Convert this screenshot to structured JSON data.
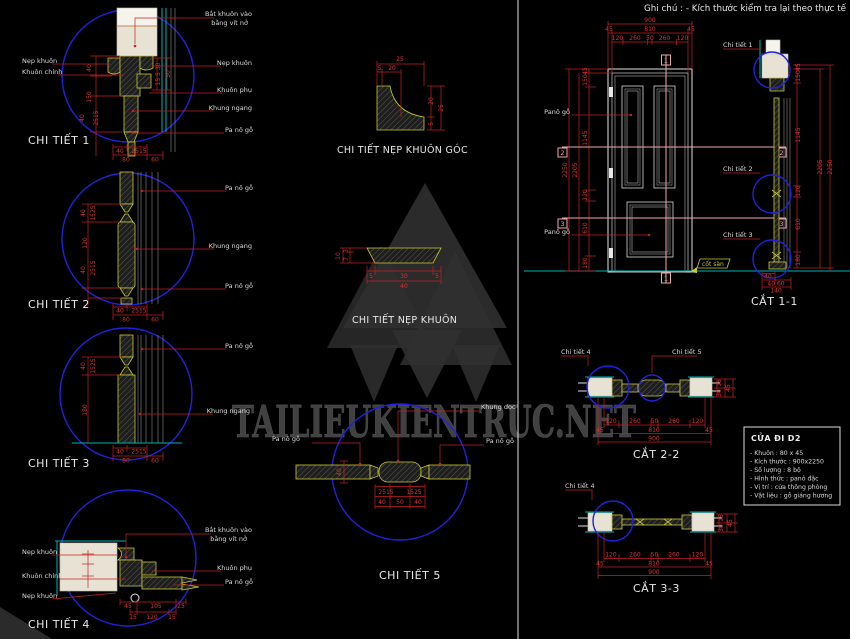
{
  "app": {
    "background": "#000000",
    "red": "#c32222",
    "yellow": "#c9c932",
    "cyan": "#00b4b4",
    "blue": "#2121dc",
    "pink": "#efa8a8"
  },
  "note": {
    "ghi_chu": "Ghi chú : - Kích thước kiểm tra lại theo thực tế"
  },
  "watermark": {
    "text": "TAILIEUKIENTRUC.NET"
  },
  "details": {
    "d1": {
      "title": "CHI TIẾT 1",
      "labels_left": [
        "Nẹp khuôn",
        "Khuôn chính"
      ],
      "labels_right": [
        "Bắt khuôn vào",
        "bằng vít nở",
        "Nẹp khuôn",
        "Khuôn phụ",
        "Khung ngang",
        "Pa nô gỗ"
      ],
      "dims_left": [
        "40",
        "150",
        "2515",
        "40"
      ],
      "dims_right": [
        "15 5 30",
        "50"
      ],
      "dims_bottom": [
        "40",
        "2515",
        "80",
        "60"
      ]
    },
    "d2": {
      "title": "CHI TIẾT 2",
      "labels_right": [
        "Pa nô gỗ",
        "Khung ngang",
        "Pa nô gỗ"
      ],
      "dims_left": [
        "40",
        "1525",
        "120",
        "2515",
        "40"
      ],
      "dims_bottom": [
        "40",
        "2515",
        "80",
        "60"
      ]
    },
    "d3": {
      "title": "CHI TIẾT 3",
      "labels_right": [
        "Pa nô gỗ",
        "Khung ngang"
      ],
      "dims_left": [
        "40",
        "1525",
        "180"
      ],
      "dims_bottom": [
        "40",
        "2515",
        "80",
        "60"
      ]
    },
    "d4": {
      "title": "CHI TIẾT 4",
      "labels_left": [
        "Nẹp khuôn",
        "Khuôn chính",
        "Nẹp khuôn"
      ],
      "labels_right": [
        "Bắt khuôn vào",
        "bằng vít nở",
        "Khuôn phụ",
        "Pa nô gỗ"
      ],
      "dims_row1": [
        "45",
        "105",
        "25"
      ],
      "dims_row2": [
        "15",
        "120",
        "15"
      ]
    },
    "d5": {
      "title": "CHI TIẾT 5",
      "labels": [
        "Khung dọc",
        "Pa nô gỗ",
        "Pa nô gỗ"
      ],
      "dim_left": "40",
      "dims_row1": [
        "2515",
        "1525"
      ],
      "dims_row2": [
        "40",
        "50",
        "40"
      ]
    },
    "goc": {
      "title": "CHI TIẾT NẸP KHUÔN GÓC",
      "dims_top": [
        "25",
        "5",
        "20"
      ],
      "dims_right": [
        "20",
        "5",
        "25"
      ]
    },
    "nep": {
      "title": "CHI TIẾT NẸP KHUÔN",
      "dims_left": [
        "3",
        "7",
        "10"
      ],
      "dims_bottom": [
        "5",
        "30",
        "5",
        "40"
      ]
    }
  },
  "elevation": {
    "labels": [
      "Panô gỗ",
      "Panô gỗ"
    ],
    "dims_top_total": "900",
    "dims_top_mid": [
      "45",
      "810",
      "45"
    ],
    "dims_top_inner": [
      "120",
      "260",
      "50",
      "260",
      "120"
    ],
    "dims_left": [
      "45",
      "150",
      "1145",
      "120",
      "610",
      "180"
    ],
    "dims_left_totals": [
      "2205",
      "2250"
    ],
    "marker1": "1",
    "marker2": "2",
    "marker3": "3",
    "cot_san": "cốt sàn"
  },
  "cat11": {
    "title": "CẮT 1-1",
    "callouts": [
      "Chi tiết 1",
      "Chi tiết 2",
      "Chi tiết 3"
    ],
    "dims_right": [
      "45",
      "150",
      "1145",
      "120",
      "610",
      "180"
    ],
    "dims_right_totals": [
      "2205",
      "2250"
    ],
    "dims_bottom": [
      "40",
      "40 60",
      "140"
    ]
  },
  "cat22": {
    "title": "CẮT 2-2",
    "callouts": [
      "Chi tiết 4",
      "Chi tiết 5"
    ],
    "dims_inner": [
      "120",
      "260",
      "50",
      "260",
      "120"
    ],
    "dims_mid": [
      "45",
      "810",
      "45"
    ],
    "dims_total": "900",
    "dims_right": [
      "15",
      "30",
      "45"
    ]
  },
  "cat33": {
    "title": "CẮT 3-3",
    "callouts": [
      "Chi tiết 4"
    ],
    "dims_inner": [
      "120",
      "260",
      "50",
      "260",
      "120"
    ],
    "dims_mid": [
      "45",
      "810",
      "45"
    ],
    "dims_total": "900",
    "dims_right": [
      "15",
      "30",
      "45"
    ]
  },
  "titleblock": {
    "title": "CỬA ĐI D2",
    "rows": [
      "- Khuôn : 80 x 45",
      "- Kích thước : 900x2250",
      "- Số lượng : 8 bộ",
      "- Hình thức : panô đặc",
      "- Vị trí : cửa thông phòng",
      "- Vật liệu : gỗ giáng hương"
    ]
  }
}
